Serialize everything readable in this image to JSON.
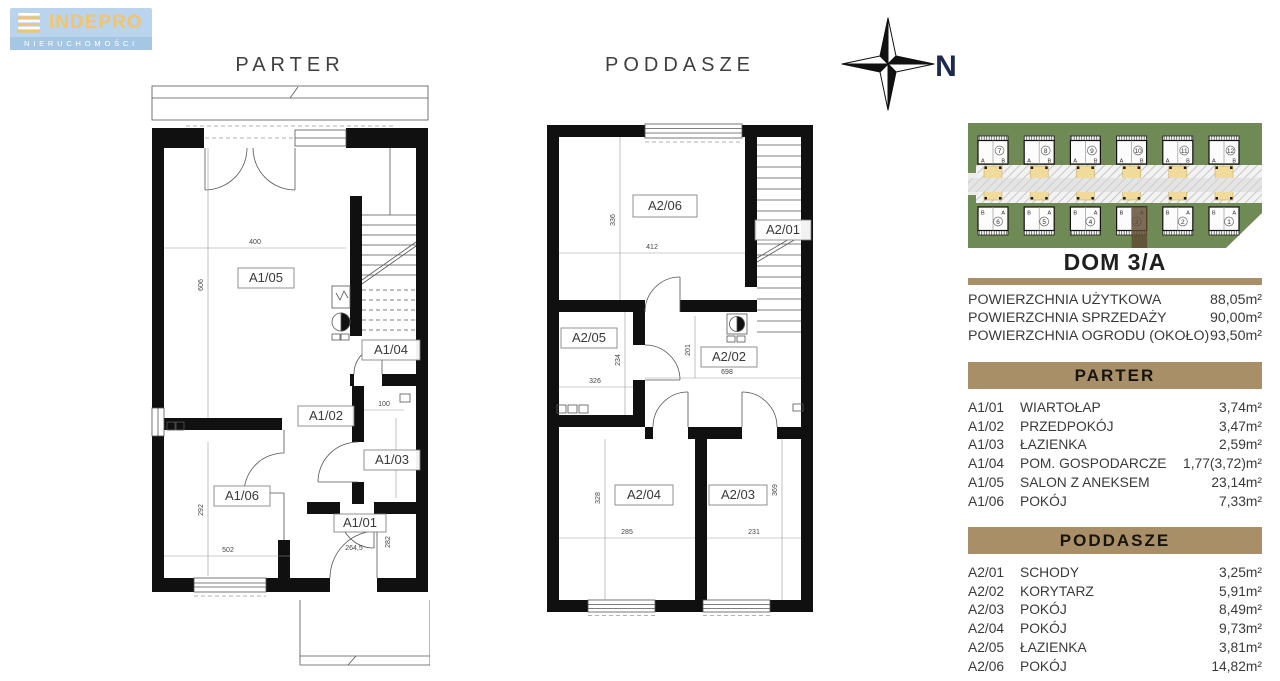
{
  "logo": {
    "title": "INDEPRO",
    "subtitle": "NIERUCHOMOŚCI"
  },
  "titles": {
    "parter": "PARTER",
    "poddasze": "PODDASZE"
  },
  "compass": {
    "north": "N"
  },
  "parter_plan": {
    "rooms": {
      "a105": "A1/05",
      "a104": "A1/04",
      "a102": "A1/02",
      "a103": "A1/03",
      "a106": "A1/06",
      "a101": "A1/01"
    },
    "dims": {
      "d400": "400",
      "d606": "606",
      "d100": "100",
      "d259": "259",
      "d292": "292",
      "d502": "502",
      "d2645": "264,5",
      "d282": "282"
    }
  },
  "poddasze_plan": {
    "rooms": {
      "a206": "A2/06",
      "a201": "A2/01",
      "a205": "A2/05",
      "a202": "A2/02",
      "a204": "A2/04",
      "a203": "A2/03"
    },
    "dims": {
      "d336": "336",
      "d412": "412",
      "d234": "234",
      "d326": "326",
      "d201": "201",
      "d698": "698",
      "d328": "328",
      "d285": "285",
      "d369": "369",
      "d231": "231"
    }
  },
  "site_plan": {
    "top_row": [
      {
        "number": "7",
        "left": "A",
        "right": "B"
      },
      {
        "number": "8",
        "left": "A",
        "right": "B"
      },
      {
        "number": "9",
        "left": "A",
        "right": "B"
      },
      {
        "number": "10",
        "left": "A",
        "right": "B"
      },
      {
        "number": "11",
        "left": "A",
        "right": "B"
      },
      {
        "number": "12",
        "left": "A",
        "right": "B"
      }
    ],
    "bottom_row": [
      {
        "number": "6",
        "left": "B",
        "right": "A"
      },
      {
        "number": "5",
        "left": "B",
        "right": "A"
      },
      {
        "number": "4",
        "left": "B",
        "right": "A"
      },
      {
        "number": "3",
        "left": "B",
        "right": "A"
      },
      {
        "number": "2",
        "left": "B",
        "right": "A"
      },
      {
        "number": "1",
        "left": "B",
        "right": "A"
      }
    ],
    "highlighted_unit": "3/A"
  },
  "panel": {
    "title": "DOM 3/A",
    "summary": [
      {
        "label": "POWIERZCHNIA UŻYTKOWA",
        "value": "88,05m²"
      },
      {
        "label": "POWIERZCHNIA SPRZEDAŻY",
        "value": "90,00m²"
      },
      {
        "label": "POWIERZCHNIA OGRODU (OKOŁO)",
        "value": "93,50m²"
      }
    ],
    "sections": [
      {
        "title": "PARTER",
        "rows": [
          {
            "code": "A1/01",
            "name": "WIARTOŁAP",
            "area": "3,74m²"
          },
          {
            "code": "A1/02",
            "name": "PRZEDPOKÓJ",
            "area": "3,47m²"
          },
          {
            "code": "A1/03",
            "name": "ŁAZIENKA",
            "area": "2,59m²"
          },
          {
            "code": "A1/04",
            "name": "POM. GOSPODARCZE",
            "area": "1,77(3,72)m²"
          },
          {
            "code": "A1/05",
            "name": "SALON Z ANEKSEM",
            "area": "23,14m²"
          },
          {
            "code": "A1/06",
            "name": "POKÓJ",
            "area": "7,33m²"
          }
        ]
      },
      {
        "title": "PODDASZE",
        "rows": [
          {
            "code": "A2/01",
            "name": "SCHODY",
            "area": "3,25m²"
          },
          {
            "code": "A2/02",
            "name": "KORYTARZ",
            "area": "5,91m²"
          },
          {
            "code": "A2/03",
            "name": "POKÓJ",
            "area": "8,49m²"
          },
          {
            "code": "A2/04",
            "name": "POKÓJ",
            "area": "9,73m²"
          },
          {
            "code": "A2/05",
            "name": "ŁAZIENKA",
            "area": "3,81m²"
          },
          {
            "code": "A2/06",
            "name": "POKÓJ",
            "area": "14,82m²"
          }
        ]
      }
    ]
  },
  "colors": {
    "accent_tan": "#a98f68",
    "site_green": "#6f8a55",
    "highlight_brown": "#5e4b31",
    "logo_blue": "#b9d4ec",
    "logo_gold": "#f2c46d",
    "compass_navy": "#1c2a4d",
    "parking_yellow": "#f0db9b"
  }
}
